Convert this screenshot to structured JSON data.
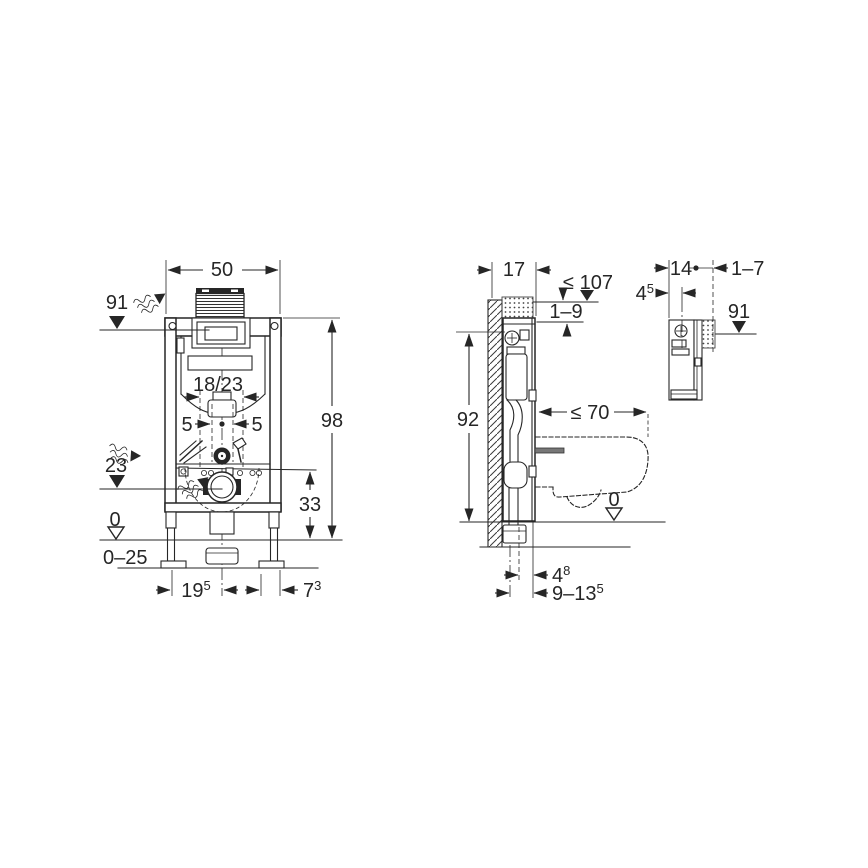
{
  "colors": {
    "line": "#262626",
    "text": "#262626",
    "background": "#ffffff"
  },
  "drawing": {
    "front_view": {
      "dim_width": "50",
      "marker_supply_height": "91",
      "dim_height": "98",
      "dim_flush_pipe_spacing": "18/23",
      "dim_offset_left": "5",
      "dim_offset_right": "5",
      "marker_outlet_height": "23",
      "marker_floor": "0",
      "dim_floor_range": "0–25",
      "dim_fixing_height": "33",
      "dim_foot_offset": {
        "base": "19",
        "sup": "5"
      },
      "dim_foot_width": {
        "base": "7",
        "sup": "3"
      }
    },
    "side_view": {
      "dim_depth": "17",
      "marker_max_height": "≤ 107",
      "dim_protrusion_range": "1–9",
      "dim_frame_height": "92",
      "dim_bowl_depth": "≤ 70",
      "marker_floor": "0",
      "dim_outlet_offset": {
        "base": "4",
        "sup": "8"
      },
      "dim_outlet_range": {
        "base": "9–13",
        "sup": "5"
      }
    },
    "detail_view": {
      "dim_depth": "14",
      "dim_wall_finish_range": "1–7",
      "dim_connection_offset": {
        "base": "4",
        "sup": "5"
      },
      "marker_supply_height": "91"
    }
  }
}
